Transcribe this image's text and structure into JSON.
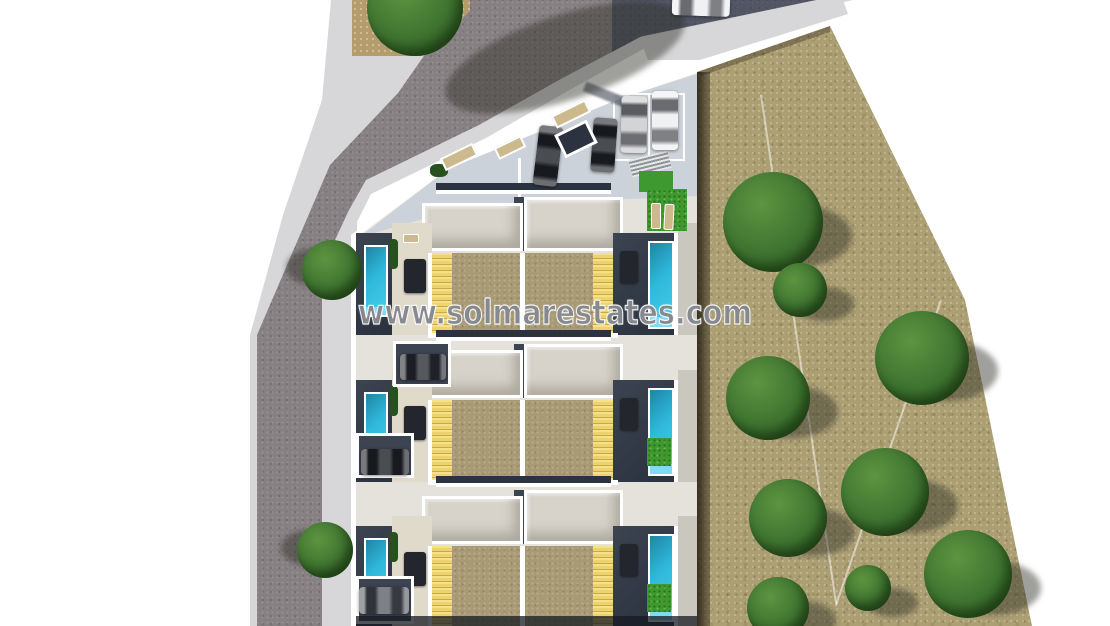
{
  "watermark": {
    "text": "www.solmarestates.com"
  },
  "palette": {
    "bg": "#ffffff",
    "road": "#878083",
    "sidewalk": "#d7d7d9",
    "field": "#ac9f74",
    "dirt": "#b49c6e",
    "plot-ground": "#e4e2db",
    "parking": "#ccd2d9",
    "white-wall": "#ffffff",
    "roof": "#d7d3ca",
    "navy": "#3c4351",
    "navy-dark": "#2c3340",
    "terrace": "#a89a74",
    "pergola": "#ecd36e",
    "pergola-stripe": "#c9a943",
    "pool": "#2fb9dc",
    "pool-light": "#7ddcef",
    "grass": "#3e9a30",
    "patio": "#e0dacb",
    "path": "#cac7bf",
    "bench": "#cdb98e",
    "tree": "#3e7330",
    "tree-light": "#5d9440",
    "tree-dark": "#27511f",
    "car-black": "#1d2025",
    "car-dark": "#2b2e35",
    "car-gray": "#5d6168",
    "car-silver": "#c9c9cc",
    "car-white": "#eceef0"
  },
  "scene": {
    "items": [
      {
        "kind": "shade",
        "name": "tree-shadow",
        "x": 440,
        "y": 15,
        "w": 250,
        "h": 85,
        "rot": -18
      },
      {
        "kind": "shade",
        "name": "tree-shadow",
        "x": 286,
        "y": 248,
        "w": 62,
        "h": 38
      },
      {
        "kind": "shade",
        "name": "tree-shadow",
        "x": 281,
        "y": 530,
        "w": 58,
        "h": 36
      },
      {
        "kind": "shade",
        "name": "tree-shadow",
        "x": 742,
        "y": 205,
        "w": 110,
        "h": 62
      },
      {
        "kind": "shade",
        "name": "tree-shadow",
        "x": 794,
        "y": 287,
        "w": 60,
        "h": 34
      },
      {
        "kind": "shade",
        "name": "tree-shadow",
        "x": 895,
        "y": 341,
        "w": 103,
        "h": 60
      },
      {
        "kind": "shade",
        "name": "tree-shadow",
        "x": 746,
        "y": 386,
        "w": 92,
        "h": 52
      },
      {
        "kind": "shade",
        "name": "tree-shadow",
        "x": 861,
        "y": 479,
        "w": 97,
        "h": 54
      },
      {
        "kind": "shade",
        "name": "tree-shadow",
        "x": 769,
        "y": 508,
        "w": 86,
        "h": 48
      },
      {
        "kind": "shade",
        "name": "tree-shadow",
        "x": 944,
        "y": 561,
        "w": 97,
        "h": 54
      },
      {
        "kind": "shade",
        "name": "tree-shadow",
        "x": 867,
        "y": 588,
        "w": 51,
        "h": 29
      },
      {
        "kind": "shade",
        "name": "tree-shadow",
        "x": 768,
        "y": 601,
        "w": 68,
        "h": 38
      },
      {
        "kind": "tree",
        "name": "street-tree",
        "x": 367,
        "y": -40,
        "w": 96,
        "h": 96
      },
      {
        "kind": "tree",
        "name": "street-tree",
        "x": 302,
        "y": 240,
        "w": 60,
        "h": 60
      },
      {
        "kind": "tree",
        "name": "street-tree",
        "x": 297,
        "y": 522,
        "w": 56,
        "h": 56
      },
      {
        "kind": "tree",
        "name": "field-tree",
        "x": 723,
        "y": 172,
        "w": 100,
        "h": 100
      },
      {
        "kind": "tree",
        "name": "field-tree",
        "x": 773,
        "y": 263,
        "w": 54,
        "h": 54
      },
      {
        "kind": "tree",
        "name": "field-tree",
        "x": 875,
        "y": 311,
        "w": 94,
        "h": 94
      },
      {
        "kind": "tree",
        "name": "field-tree",
        "x": 726,
        "y": 356,
        "w": 84,
        "h": 84
      },
      {
        "kind": "tree",
        "name": "field-tree",
        "x": 841,
        "y": 448,
        "w": 88,
        "h": 88
      },
      {
        "kind": "tree",
        "name": "field-tree",
        "x": 749,
        "y": 479,
        "w": 78,
        "h": 78
      },
      {
        "kind": "tree",
        "name": "field-tree",
        "x": 924,
        "y": 530,
        "w": 88,
        "h": 88
      },
      {
        "kind": "tree",
        "name": "field-tree",
        "x": 845,
        "y": 565,
        "w": 46,
        "h": 46
      },
      {
        "kind": "tree",
        "name": "field-tree",
        "x": 747,
        "y": 577,
        "w": 62,
        "h": 62
      },
      {
        "kind": "car",
        "axis": "h",
        "name": "parked-car-street",
        "x": 672,
        "y": -6,
        "w": 58,
        "h": 22,
        "rot": 2,
        "color": "car-white"
      },
      {
        "kind": "car",
        "axis": "v",
        "name": "parked-car-courtyard",
        "x": 536,
        "y": 126,
        "w": 24,
        "h": 60,
        "rot": 7,
        "color": "car-black"
      },
      {
        "kind": "car",
        "axis": "v",
        "name": "parked-car-courtyard",
        "x": 592,
        "y": 118,
        "w": 24,
        "h": 54,
        "rot": 4,
        "color": "car-black"
      },
      {
        "kind": "car",
        "axis": "v",
        "name": "parked-car-bay",
        "x": 621,
        "y": 96,
        "w": 26,
        "h": 57,
        "rot": 1,
        "color": "car-silver"
      },
      {
        "kind": "car",
        "axis": "v",
        "name": "parked-car-bay",
        "x": 652,
        "y": 91,
        "w": 26,
        "h": 59,
        "color": "car-white"
      },
      {
        "kind": "car",
        "axis": "h",
        "name": "driveway-car",
        "x": 400,
        "y": 354,
        "w": 46,
        "h": 26,
        "color": "car-dark"
      },
      {
        "kind": "car",
        "axis": "h",
        "name": "driveway-car",
        "x": 361,
        "y": 449,
        "w": 48,
        "h": 26,
        "color": "car-black"
      },
      {
        "kind": "car",
        "axis": "h",
        "name": "driveway-car",
        "x": 359,
        "y": 587,
        "w": 50,
        "h": 27,
        "color": "car-gray"
      },
      {
        "kind": "bench",
        "name": "street-bench",
        "x": 441,
        "y": 150,
        "w": 36,
        "h": 14,
        "rot": -26
      },
      {
        "kind": "bench",
        "name": "street-bench",
        "x": 495,
        "y": 141,
        "w": 30,
        "h": 13,
        "rot": -26
      },
      {
        "kind": "bench",
        "name": "street-bench",
        "x": 552,
        "y": 107,
        "w": 38,
        "h": 14,
        "rot": -26
      },
      {
        "kind": "planter",
        "name": "planter-box",
        "x": 558,
        "y": 126,
        "w": 36,
        "h": 26,
        "rot": -26
      },
      {
        "kind": "sun-lounger",
        "name": "sun-lounger",
        "x": 651,
        "y": 203,
        "w": 10,
        "h": 26
      },
      {
        "kind": "sun-lounger",
        "name": "sun-lounger",
        "x": 664,
        "y": 204,
        "w": 10,
        "h": 26,
        "rot": 3
      },
      {
        "kind": "sun-lounger",
        "name": "sun-lounger",
        "x": 403,
        "y": 234,
        "w": 16,
        "h": 9
      }
    ]
  }
}
